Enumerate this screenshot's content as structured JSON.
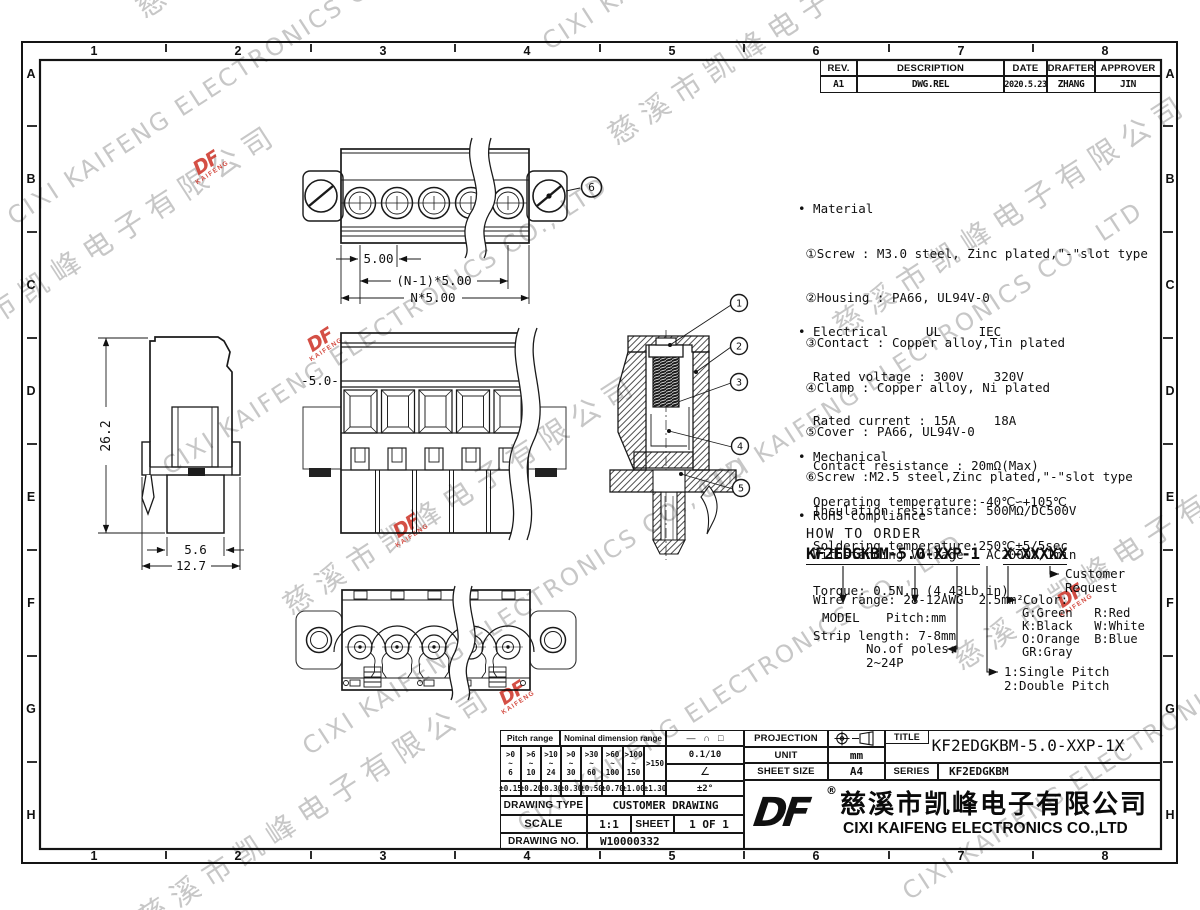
{
  "grid": {
    "cols": [
      "1",
      "2",
      "3",
      "4",
      "5",
      "6",
      "7",
      "8"
    ],
    "rows": [
      "A",
      "B",
      "C",
      "D",
      "E",
      "F",
      "G",
      "H"
    ]
  },
  "revision": {
    "headers": [
      "REV.",
      "DESCRIPTION",
      "DATE",
      "DRAFTER",
      "APPROVER"
    ],
    "row": [
      "A1",
      "DWG.REL",
      "2020.5.23",
      "ZHANG",
      "JIN"
    ]
  },
  "specs": {
    "material": {
      "title": "• Material",
      "lines": [
        " ①Screw : M3.0 steel, Zinc plated,\"-\"slot type",
        " ②Housing : PA66, UL94V-0",
        " ③Contact : Copper alloy,Tin plated",
        " ④Clamp : Copper alloy, Ni plated",
        " ⑤Cover : PA66, UL94V-0",
        " ⑥Screw :M2.5 steel,Zinc plated,\"-\"slot type"
      ]
    },
    "electrical": {
      "title": "• Electrical     UL     IEC",
      "lines": [
        "  Rated voltage : 300V    320V",
        "  Rated current : 15A     18A",
        "  Contact resistance : 20mΩ(Max)",
        "  Insulation resistance: 500MΩ/DC500V",
        "  Withstanding Voltage : AC2000V/1min",
        "  Wire range: 28-12AWG  2.5mm²"
      ]
    },
    "mechanical": {
      "title": "• Mechanical",
      "lines": [
        "  Operating temperature:-40℃∽+105℃",
        "  Soldering temperature:250℃±5/5sec",
        "  Torque: 0.5N.m (4.43Lb.in)",
        "  Strip length: 7-8mm"
      ]
    },
    "rohs": "• RoHS compliance"
  },
  "order": {
    "title": "HOW TO ORDER",
    "part1": "KF2EDGKBM-5.0-XXP-1",
    "part2": "X-XXXXX",
    "model": "MODEL",
    "pitch": "Pitch:mm",
    "poles1": "No.of poles:",
    "poles2": "2~24P",
    "type1": "1:Single Pitch",
    "type2": "2:Double Pitch",
    "color_title": "Color:",
    "colors": [
      "G:Green   R:Red",
      "K:Black   W:White",
      "O:Orange  B:Blue",
      "GR:Gray"
    ],
    "customer1": "Customer",
    "customer2": "Request"
  },
  "dims": {
    "pitch": "5.00",
    "pitch_n1": "(N-1)*5.00",
    "pitch_n": "N*5.00",
    "height": "26.2",
    "foot": "5.6",
    "depth": "12.7",
    "front_pitch": "-5.0-"
  },
  "callouts": {
    "c1": "1",
    "c2": "2",
    "c3": "3",
    "c4": "4",
    "c5": "5",
    "c6": "6"
  },
  "title_block": {
    "pitch_range": "Pitch range",
    "nominal_range": "Nominal dimension range",
    "sym_line": "—",
    "sym_arc": "∩",
    "sym_sq": "□",
    "flatness": "0.1/10",
    "angle_sym": "∠",
    "angle_tol": "±2°",
    "ranges": [
      ">0\n~\n6",
      ">6\n~\n10",
      ">10\n~\n24",
      ">0\n~\n30",
      ">30\n~\n60",
      ">60\n~\n100",
      ">100\n~\n150",
      ">150"
    ],
    "tols": [
      "±0.15",
      "±0.20",
      "±0.30",
      "±0.30",
      "±0.50",
      "±0.70",
      "±1.00",
      "±1.30"
    ],
    "drawing_type_label": "DRAWING TYPE",
    "drawing_type": "CUSTOMER DRAWING",
    "scale_label": "SCALE",
    "scale": "1:1",
    "sheet_label": "SHEET",
    "sheet": "1 OF 1",
    "drawing_no_label": "DRAWING NO.",
    "drawing_no": "W10000332",
    "projection_label": "PROJECTION",
    "unit_label": "UNIT",
    "unit": "mm",
    "sheet_size_label": "SHEET SIZE",
    "sheet_size": "A4",
    "title_label": "TITLE",
    "title": "KF2EDGKBM-5.0-XXP-1X",
    "series_label": "SERIES",
    "series": "KF2EDGKBM",
    "registered": "®",
    "company_cn": "慈溪市凯峰电子有限公司",
    "company_en": "CIXI KAIFENG ELECTRONICS CO.,LTD",
    "logo_text": "DF",
    "logo_sub": "KAIFENG"
  },
  "watermark": {
    "cn": "慈溪市凯峰电子有限公司",
    "en": "CIXI KAIFENG ELECTRONICS CO., LTD",
    "logo": "DF",
    "logo_sub": "KAIFENG"
  }
}
